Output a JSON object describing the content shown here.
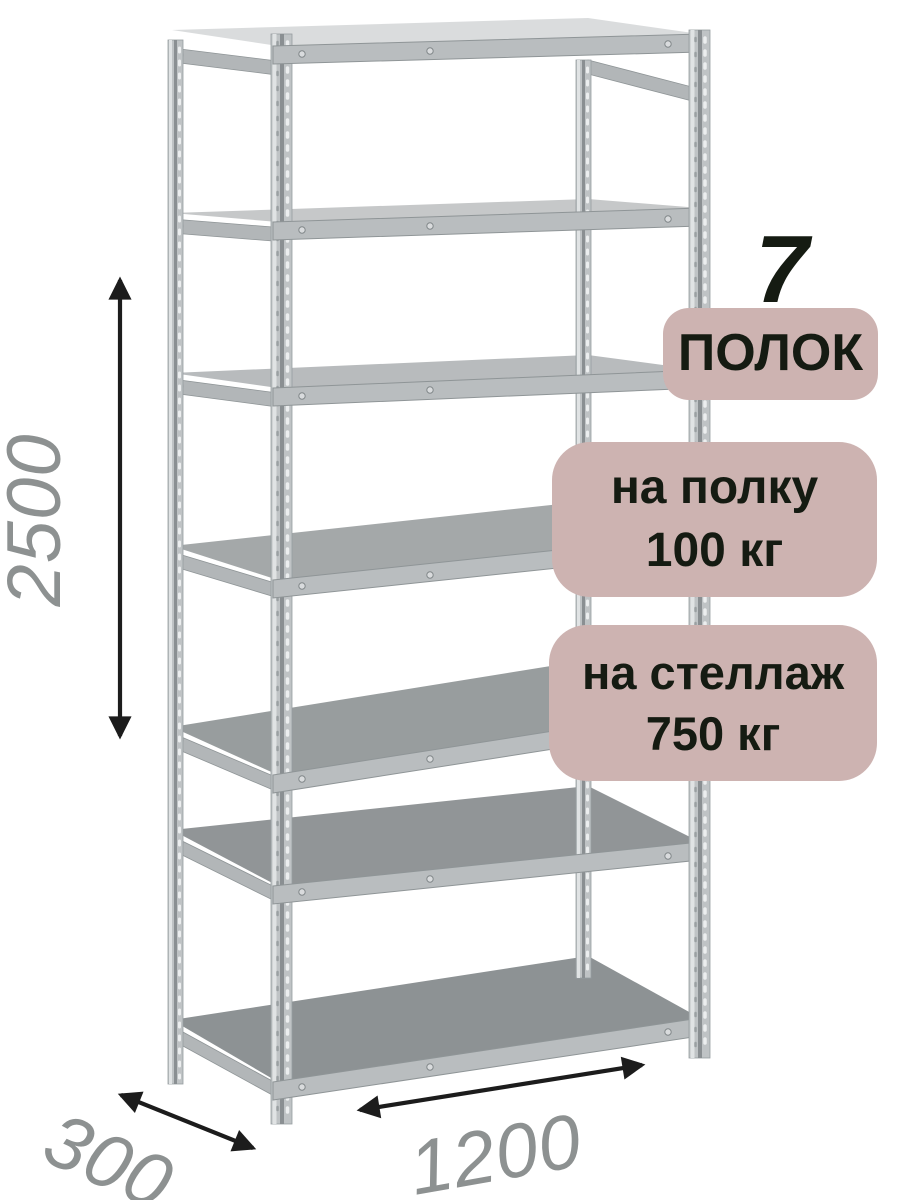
{
  "product": {
    "shelf_count": {
      "value": "7",
      "label": "ПОЛОК"
    },
    "load_per_shelf": {
      "line1": "на полку",
      "line2": "100 кг"
    },
    "load_per_rack": {
      "line1": "на стеллаж",
      "line2": "750 кг"
    }
  },
  "dimensions": {
    "height": "2500",
    "depth": "300",
    "width": "1200"
  },
  "colors": {
    "background": "#ffffff",
    "badge_bg": "#cdb3b1",
    "badge_text": "#151b12",
    "dimension_text": "#8d9191",
    "arrow": "#1c1c1c",
    "metal_mid": "#bfc3c5",
    "metal_edge": "#b9bdbf",
    "metal_dark": "#8a8f92",
    "metal_highlight": "#e0e3e4",
    "shelf_top": "#8d9294"
  }
}
